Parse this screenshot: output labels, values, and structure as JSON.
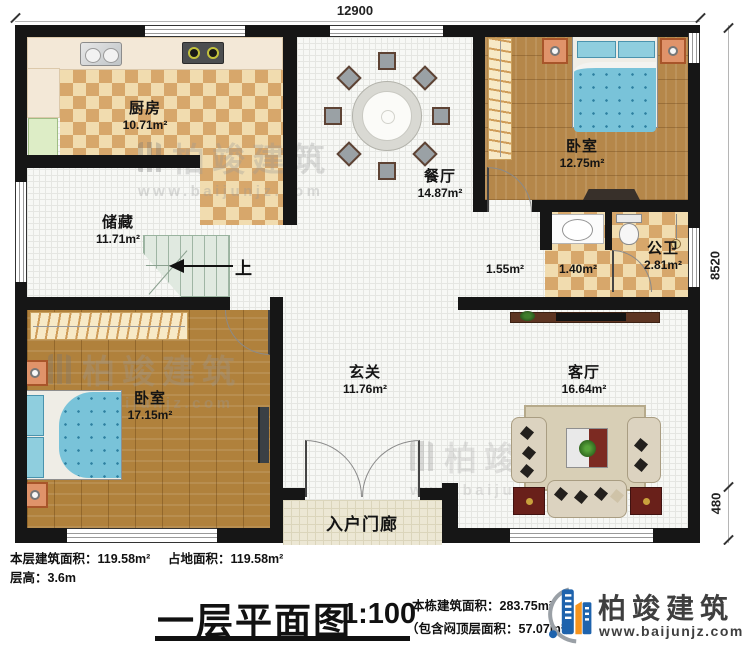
{
  "plan": {
    "dimensions": {
      "width_top": "12900",
      "height_right": "8520",
      "porch_right": "480"
    },
    "stairs": {
      "up_label": "上"
    },
    "rooms": {
      "kitchen": {
        "name": "厨房",
        "area": "10.71m²"
      },
      "dining": {
        "name": "餐厅",
        "area": "14.87m²"
      },
      "storage": {
        "name": "储藏",
        "area": "11.71m²"
      },
      "bedroom_left": {
        "name": "卧室",
        "area": "17.15m²"
      },
      "bedroom_right": {
        "name": "卧室",
        "area": "12.75m²"
      },
      "bathroom": {
        "name": "公卫",
        "area": "2.81m²"
      },
      "hall": {
        "name": "玄关",
        "area": "11.76m²"
      },
      "living": {
        "name": "客厅",
        "area": "16.64m²"
      },
      "porch": {
        "name": "入户门廊"
      },
      "lobby_area": {
        "area": "1.55m²"
      },
      "wash_area": {
        "area": "1.40m²"
      }
    }
  },
  "footer": {
    "floor_area": "本层建筑面积：119.58m²",
    "land_area": "占地面积：119.58m²",
    "floor_height": "层高：3.6m",
    "title": "一层平面图",
    "scale": "1:100",
    "total_area": "本栋建筑面积：283.75m²",
    "attic_area": "（包含闷顶层面积：57.07m²）"
  },
  "brand": {
    "name": "柏竣建筑",
    "website": "www.baijunjz.com"
  },
  "watermark": {
    "name": "柏竣建筑",
    "website": "www.baijunjz.com"
  }
}
